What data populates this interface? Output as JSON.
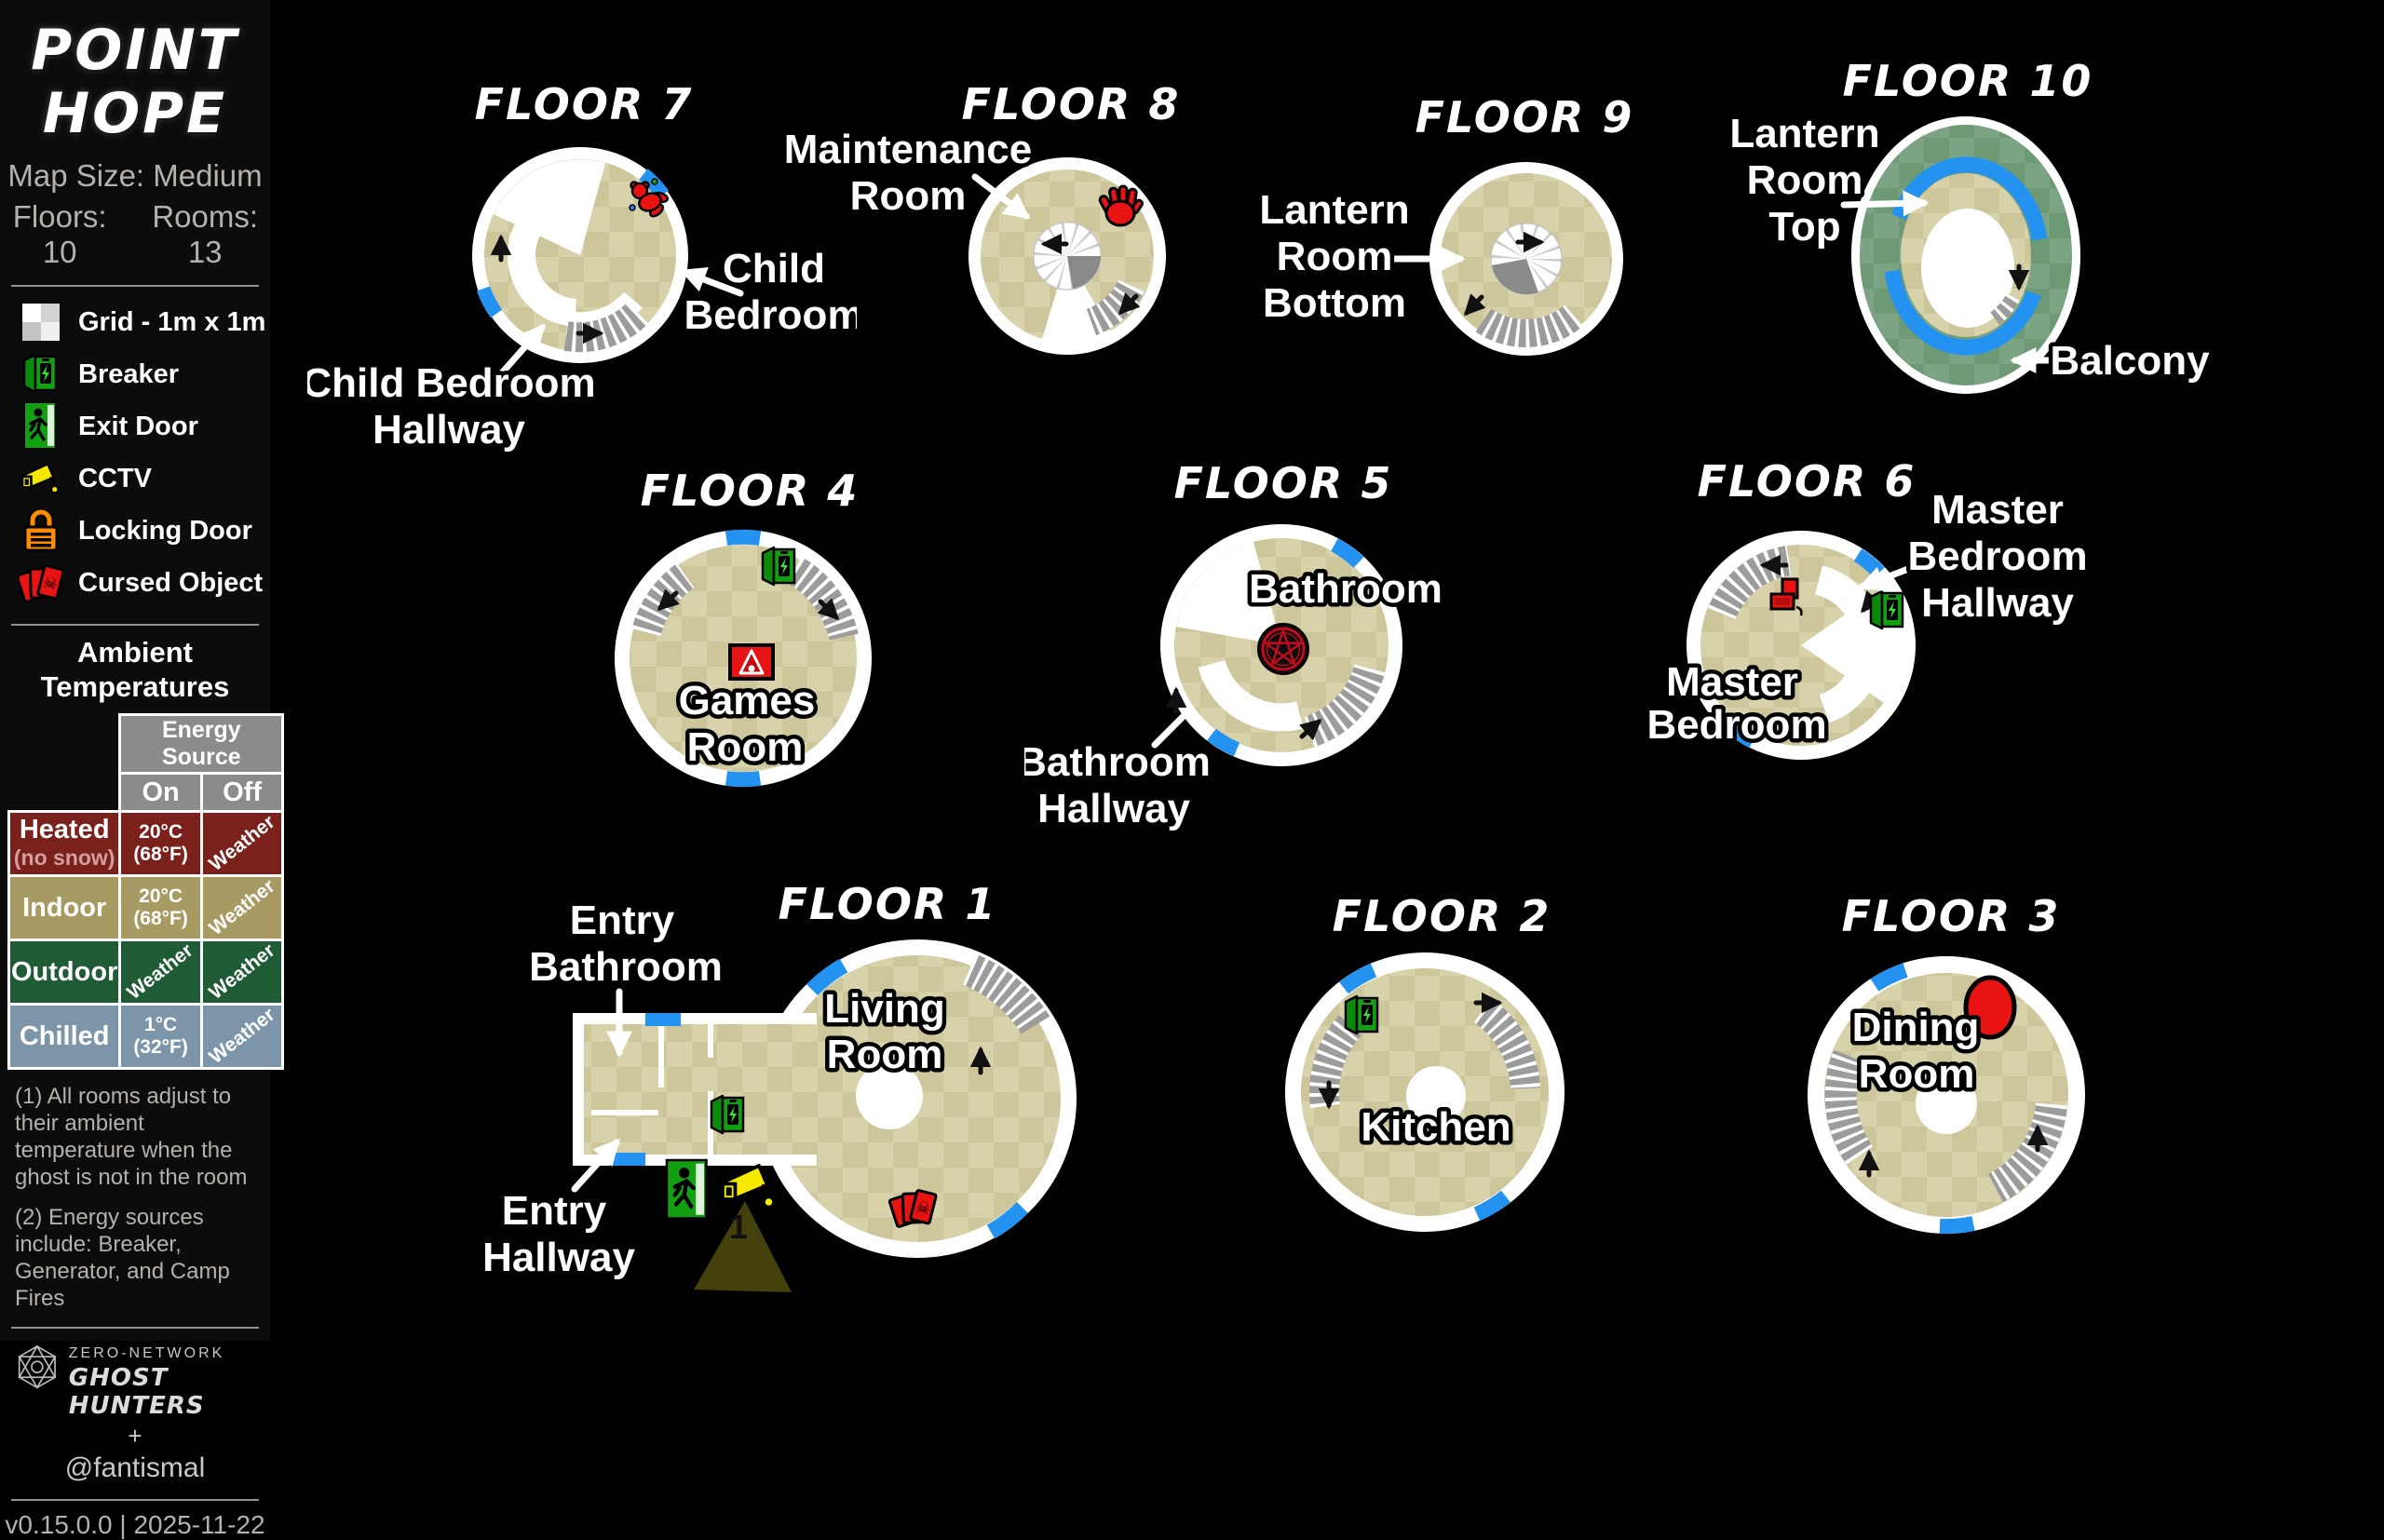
{
  "sidebar": {
    "title_lines": [
      "POINT",
      "HOPE"
    ],
    "map_size": "Map Size: Medium",
    "floors_label": "Floors: 10",
    "rooms_label": "Rooms: 13",
    "legend": [
      {
        "icon": "grid-icon",
        "label": "Grid - 1m x 1m"
      },
      {
        "icon": "breaker-icon",
        "label": "Breaker"
      },
      {
        "icon": "exit-door-icon",
        "label": "Exit Door"
      },
      {
        "icon": "cctv-icon",
        "label": "CCTV"
      },
      {
        "icon": "locking-door-icon",
        "label": "Locking Door"
      },
      {
        "icon": "cursed-object-icon",
        "label": "Cursed Object"
      }
    ],
    "temps": {
      "heading_lines": [
        "Ambient",
        "Temperatures"
      ],
      "col_group": "Energy Source",
      "col_on": "On",
      "col_off": "Off",
      "rows": [
        {
          "name": "Heated",
          "sub": "(no snow)",
          "on_top": "20°C",
          "on_bottom": "(68°F)",
          "off": "Weather",
          "bg": "#7b211c"
        },
        {
          "name": "Indoor",
          "sub": "",
          "on_top": "20°C",
          "on_bottom": "(68°F)",
          "off": "Weather",
          "bg": "#a79a62"
        },
        {
          "name": "Outdoor",
          "sub": "",
          "on": "Weather",
          "off": "Weather",
          "bg": "#1f5c35"
        },
        {
          "name": "Chilled",
          "sub": "",
          "on_top": "1°C",
          "on_bottom": "(32°F)",
          "off": "Weather",
          "bg": "#7d95a9"
        }
      ]
    },
    "notes": [
      "(1) All rooms adjust to their ambient temperature when the ghost is not in the room",
      "(2) Energy sources include: Breaker, Generator, and Camp Fires"
    ],
    "credit": {
      "network": "ZERO-NETWORK",
      "brand": "GHOST HUNTERS",
      "plus": "+",
      "handle": "@fantismal"
    },
    "version": "v0.15.0.0 | 2025-11-22"
  },
  "floors": {
    "f1": {
      "title": "FLOOR 1",
      "living_room": [
        "Living",
        "Room"
      ],
      "entry_bathroom": [
        "Entry",
        "Bathroom"
      ],
      "entry_hallway": [
        "Entry",
        "Hallway"
      ],
      "cctv_id": "1"
    },
    "f2": {
      "title": "FLOOR 2",
      "kitchen": "Kitchen"
    },
    "f3": {
      "title": "FLOOR 3",
      "dining_room": [
        "Dining",
        "Room"
      ]
    },
    "f4": {
      "title": "FLOOR 4",
      "games_room": [
        "Games",
        "Room"
      ]
    },
    "f5": {
      "title": "FLOOR 5",
      "bathroom": "Bathroom",
      "bathroom_hallway": [
        "Bathroom",
        "Hallway"
      ]
    },
    "f6": {
      "title": "FLOOR 6",
      "master_bedroom": [
        "Master",
        "Bedroom"
      ],
      "master_bedroom_hallway": [
        "Master",
        "Bedroom",
        "Hallway"
      ]
    },
    "f7": {
      "title": "FLOOR 7",
      "child_bedroom": [
        "Child",
        "Bedroom"
      ],
      "child_bedroom_hallway": [
        "Child Bedroom",
        "Hallway"
      ]
    },
    "f8": {
      "title": "FLOOR 8",
      "maintenance_room": [
        "Maintenance",
        "Room"
      ]
    },
    "f9": {
      "title": "FLOOR 9",
      "lantern_room_bottom": [
        "Lantern",
        "Room",
        "Bottom"
      ]
    },
    "f10": {
      "title": "FLOOR 10",
      "lantern_room_top": [
        "Lantern",
        "Room",
        "Top"
      ],
      "balcony": "Balcony"
    }
  },
  "colors": {
    "door_blue": "#2492f0",
    "floor_tan_light": "#d8d2ab",
    "floor_tan_dark": "#cdc69a",
    "balcony_green_light": "#7ca383",
    "balcony_green_dark": "#6d9a75",
    "cursed_red": "#e81313",
    "exit_green": "#12a012",
    "cctv_yellow": "#f5e900",
    "lock_orange": "#ff8c00",
    "heated_row": "#7b211c",
    "indoor_row": "#a79a62",
    "outdoor_row": "#1f5c35",
    "chilled_row": "#7d95a9"
  }
}
